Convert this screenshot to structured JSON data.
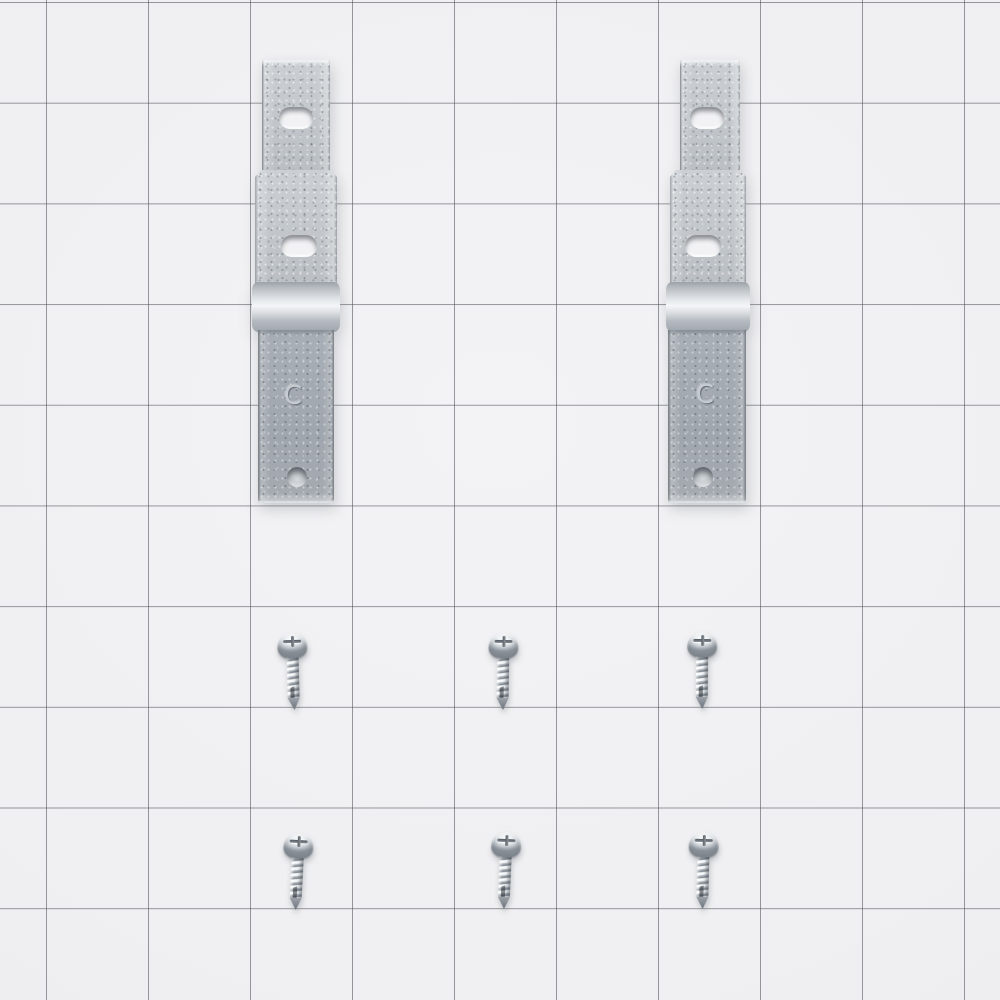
{
  "scene": {
    "type": "product-photo",
    "description": "Two galvanized steel mounting brackets stamped with the letter C and six zinc Phillips pan-head self-tapping screws arranged on white grid paper",
    "object_counts": {
      "brackets": 2,
      "screws": 6
    },
    "screw_layout": {
      "rows": 2,
      "per_row": 3
    },
    "brackets": [
      {
        "id": "left",
        "marking": "C"
      },
      {
        "id": "right",
        "marking": "C"
      }
    ],
    "screw_type": "phillips-pan-head",
    "palette": {
      "background": "#f0f0f2",
      "grid_line": "#84868c",
      "bracket_metal_light": "#c4c9ce",
      "bracket_metal_dark": "#a0a6ad",
      "bend_highlight": "#f3f5f6",
      "screw_metal": "#d9dee2",
      "screw_shadow": "#868d95"
    }
  }
}
